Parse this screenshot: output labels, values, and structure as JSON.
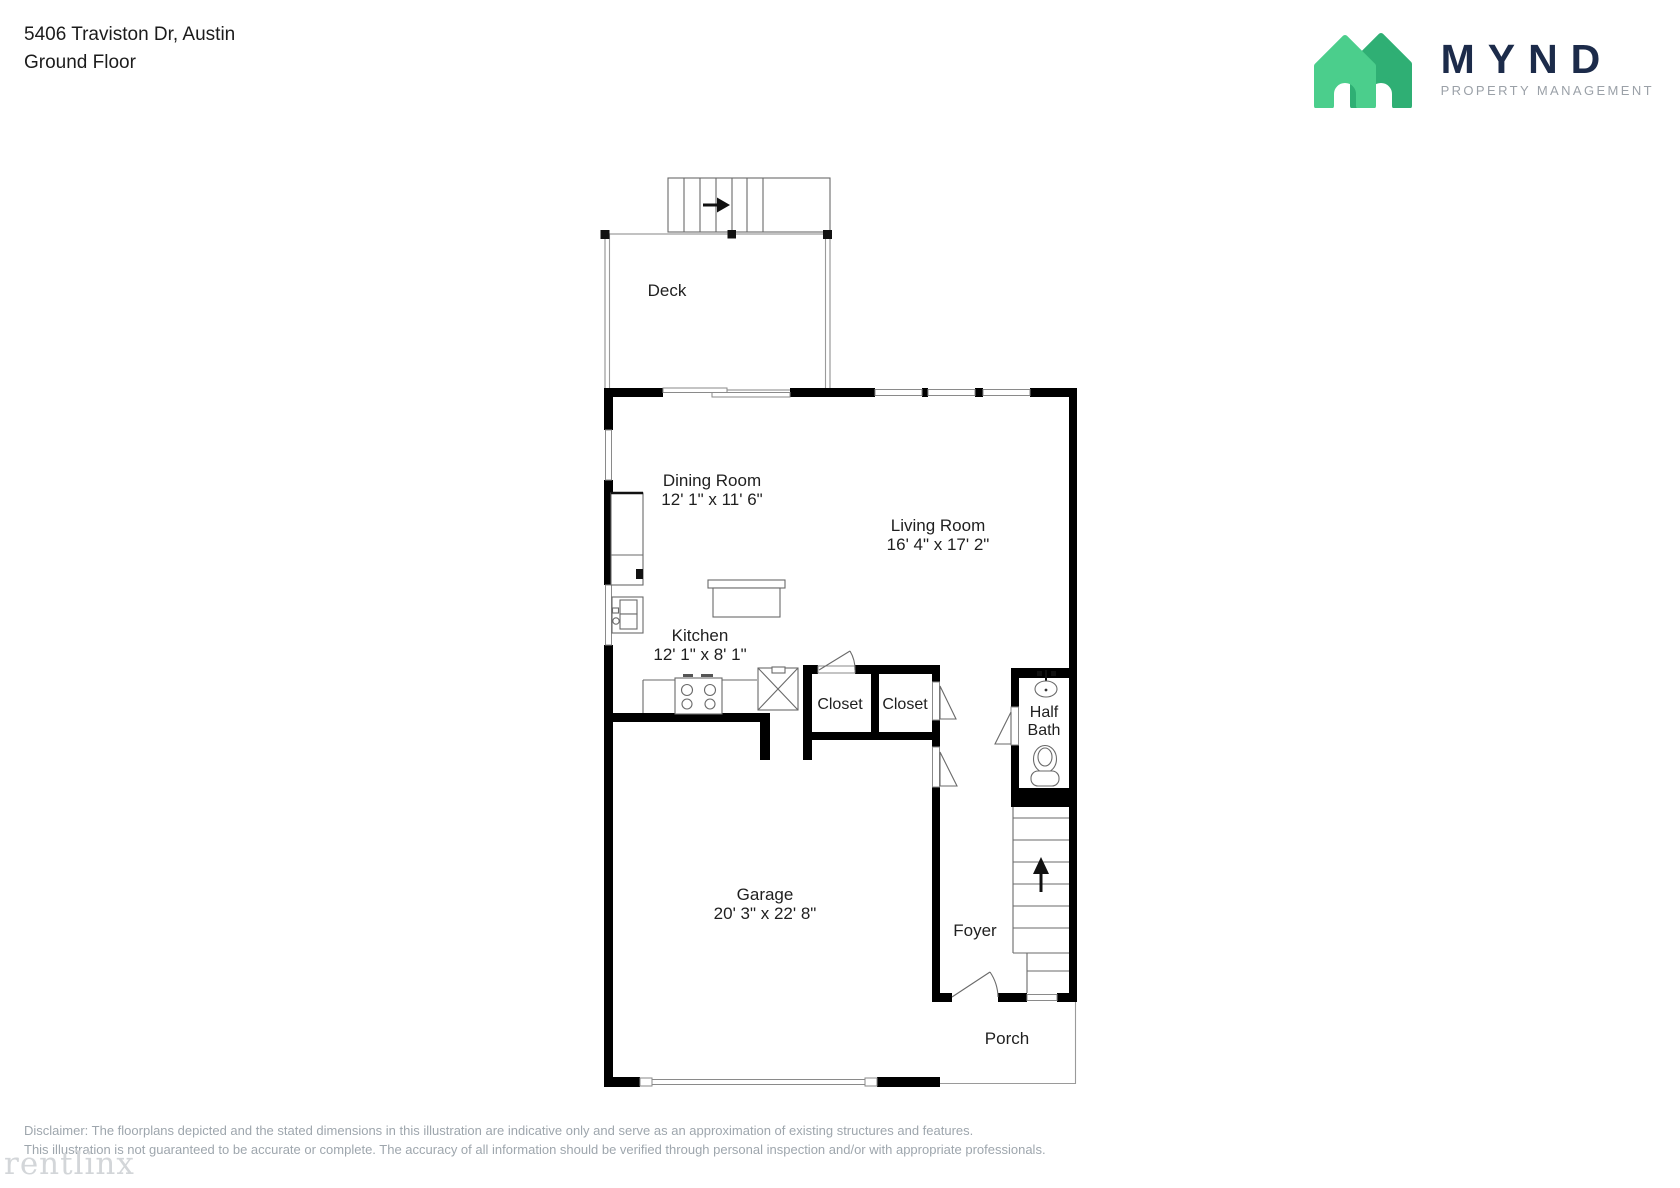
{
  "header": {
    "address": "5406 Traviston Dr, Austin",
    "floor": "Ground Floor"
  },
  "brand": {
    "name": "MYND",
    "tagline": "PROPERTY MANAGEMENT",
    "colors": {
      "house_front_green": "#4BCE8C",
      "house_back_green": "#2FAF74",
      "navy": "#1C2B4A",
      "tagline_gray": "#9BA1A8"
    }
  },
  "rooms": {
    "deck": {
      "label": "Deck"
    },
    "dining": {
      "label": "Dining Room",
      "dims": "12' 1\" x 11' 6\""
    },
    "living": {
      "label": "Living Room",
      "dims": "16' 4\" x 17' 2\""
    },
    "kitchen": {
      "label": "Kitchen",
      "dims": "12' 1\" x 8' 1\""
    },
    "closet1": {
      "label": "Closet"
    },
    "closet2": {
      "label": "Closet"
    },
    "halfbath": {
      "label_line1": "Half",
      "label_line2": "Bath"
    },
    "garage": {
      "label": "Garage",
      "dims": "20' 3\" x 22' 8\""
    },
    "foyer": {
      "label": "Foyer"
    },
    "porch": {
      "label": "Porch"
    }
  },
  "icons": {
    "up_arrow": "stairs-up-arrow",
    "right_arrow": "deck-stairs-arrow"
  },
  "plan_colors": {
    "wall": "#000000",
    "thin_line": "#6a6a6a",
    "window_line": "#8a8a8a"
  },
  "footer": {
    "disclaimer_line1": "Disclaimer: The floorplans depicted and the stated dimensions in this illustration are indicative only and serve as an approximation of existing structures and features.",
    "disclaimer_line2": "This illustration is not guaranteed to be accurate or complete. The accuracy of all information should be verified through personal inspection and/or with appropriate professionals.",
    "watermark": "rentlinx"
  }
}
